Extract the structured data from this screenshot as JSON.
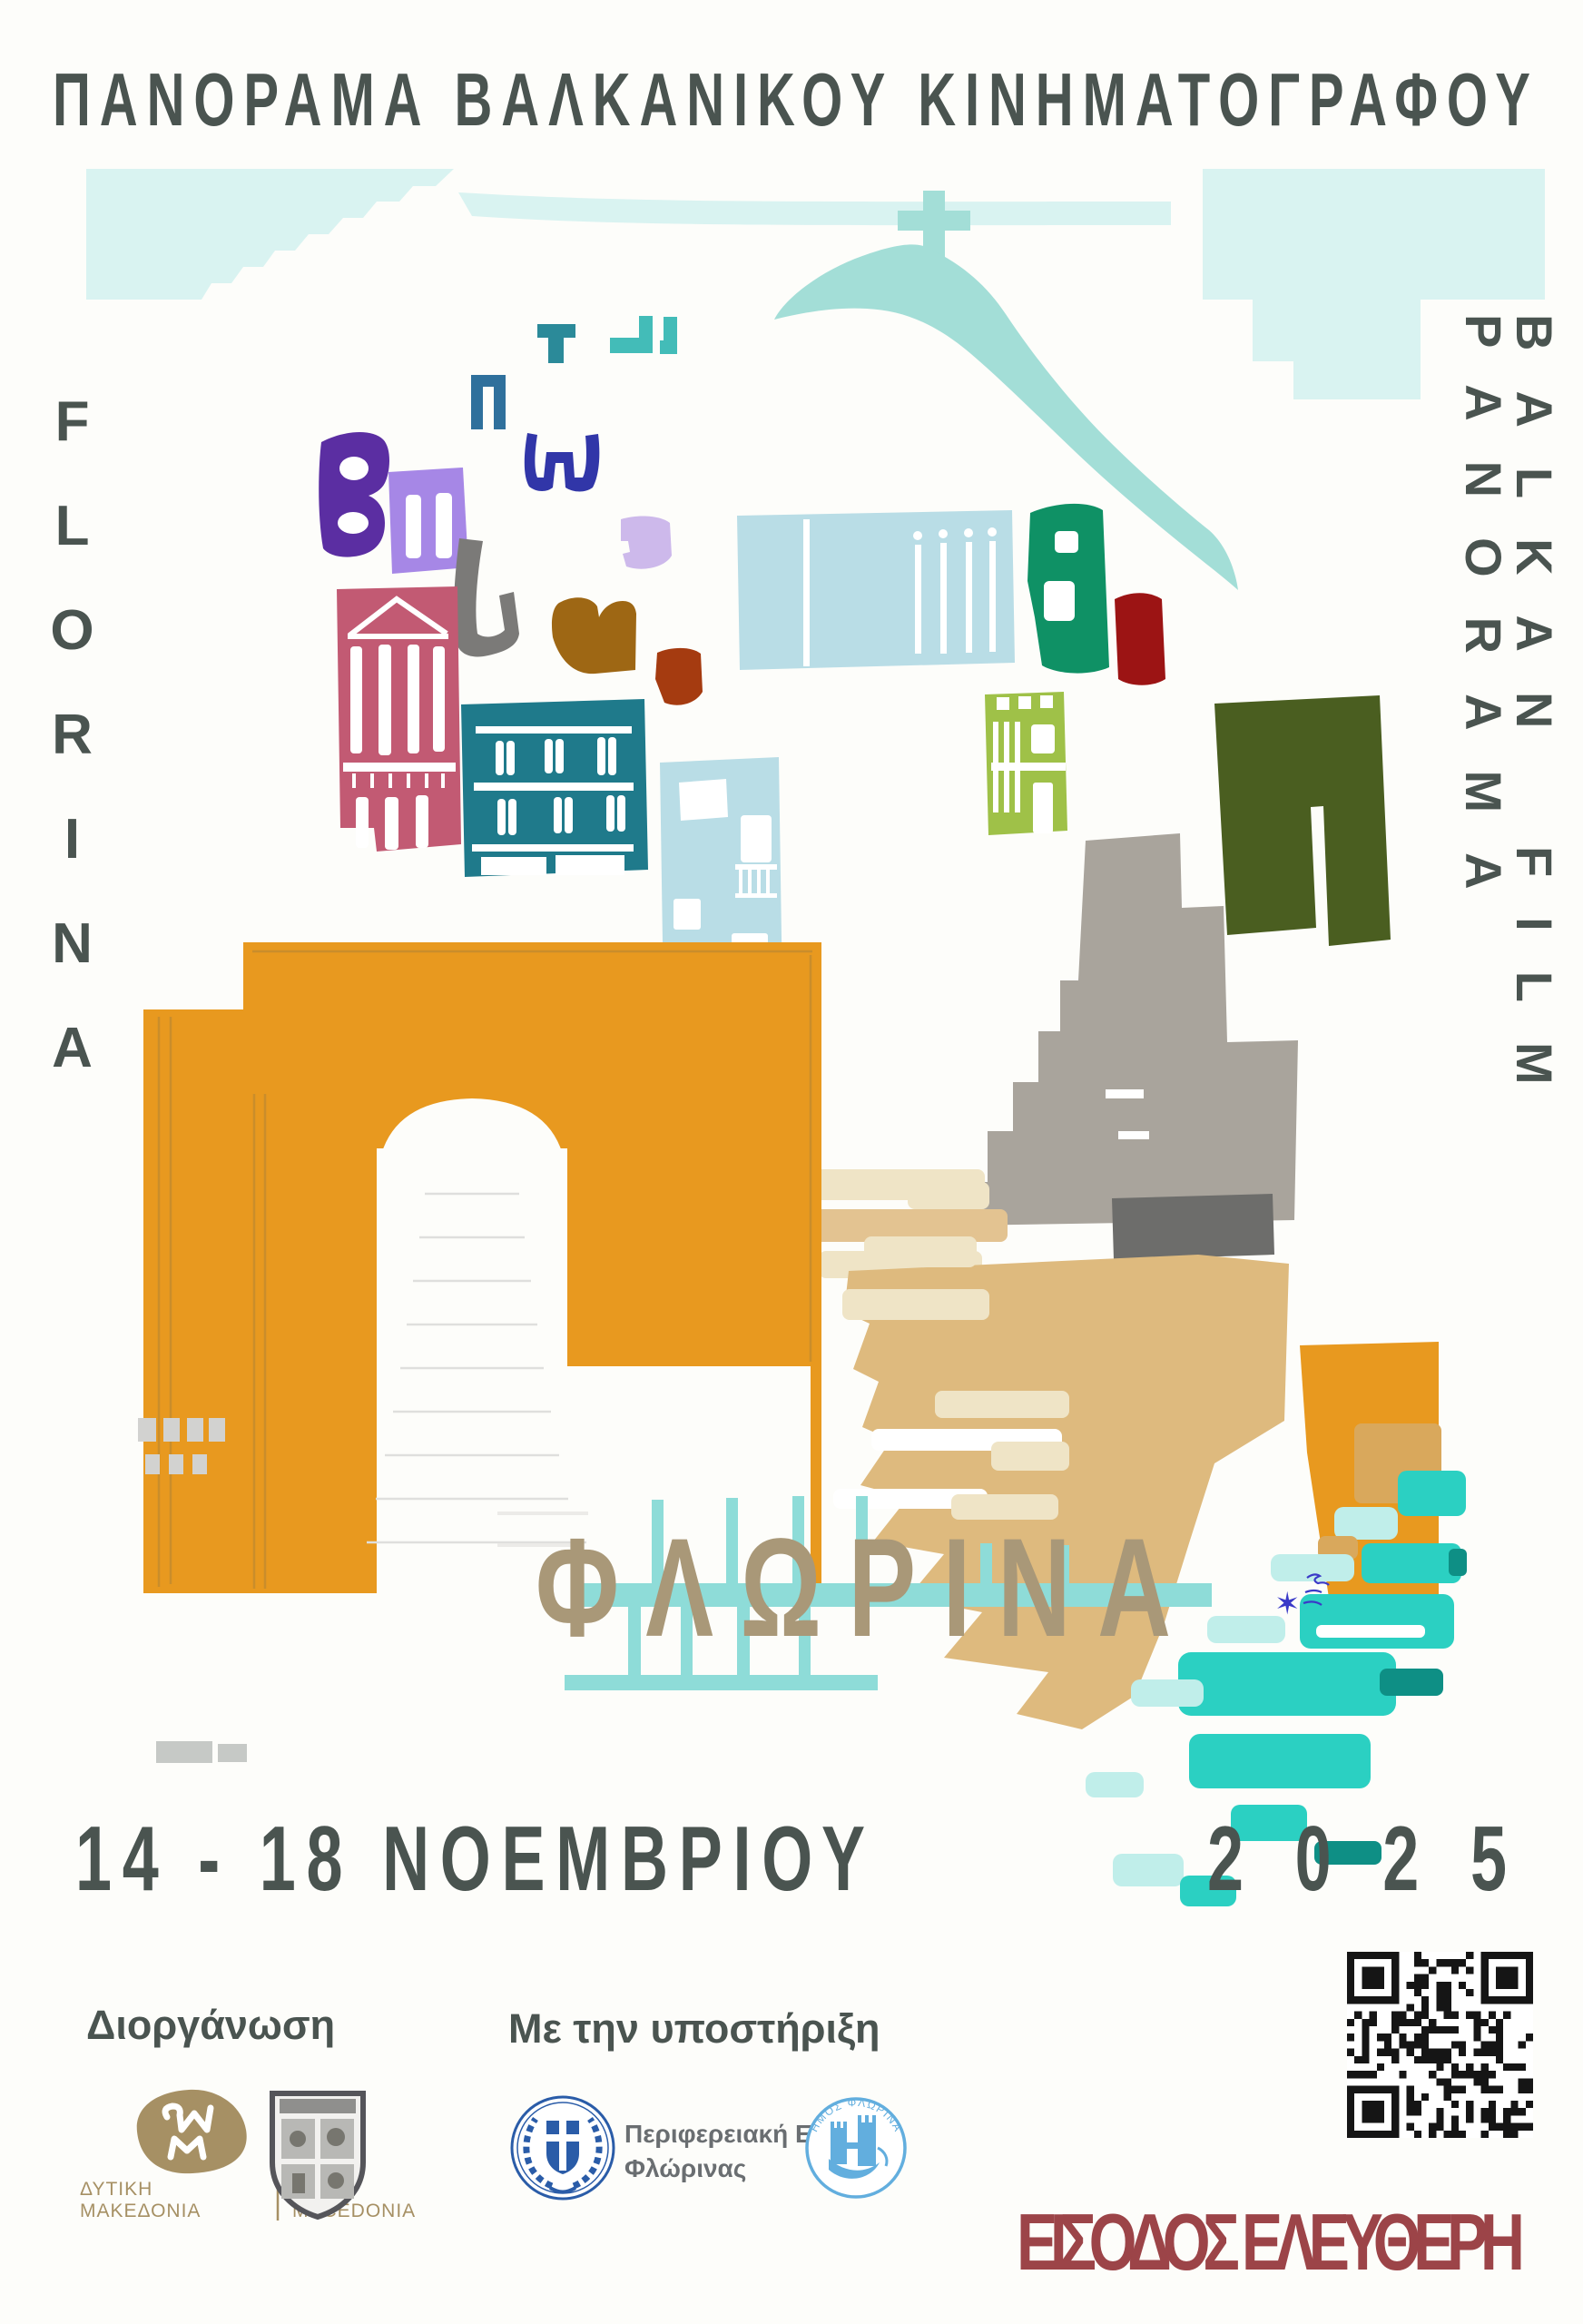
{
  "poster": {
    "title": "ΠΑΝΟΡΑΜΑ ΒΑΛΚΑΝΙΚΟΥ ΚΙΝΗΜΑΤΟΓΡΑΦΟΥ",
    "city_vertical_latin": "FLORINA",
    "festival_vertical_latin": "BALKAN FILM PANORAMA",
    "city_greek": "ΦΛΩΡΙΝΑ",
    "date_range": "14 - 18 ΝΟΕΜΒΡΙΟΥ",
    "year": "2025",
    "free_entry": "ΕΙΣΟΔΟΣ ΕΛΕΥΘΕΡΗ"
  },
  "footer": {
    "organizer_label": "Διοργάνωση",
    "support_label": "Με την υποστήριξη",
    "west_macedonia_logo": {
      "greek_line1": "ΔΥΤΙΚΗ",
      "greek_line2": "ΜΑΚΕΔΟΝΙΑ",
      "latin_line1": "WEST",
      "latin_line2": "MACEDONIA"
    },
    "regional_unit_logo": {
      "line1": "Περιφερειακή Ενότητα",
      "line2": "Φλώρινας"
    },
    "municipality_logo_arc": "ΔΗΜΟΣ ΦΛΩΡΙΝΑΣ"
  },
  "icons": {
    "signature_star": "✶"
  },
  "palette": {
    "ink": "#4a5450",
    "paper": "#fdfdfa",
    "sky": "#d9f3f1",
    "hill": "#a3ded7",
    "tan_text": "#a99878",
    "red_accent": "#9c4448",
    "arch_orange": "#e8991f",
    "pinstripe": "#c28a2e",
    "camel": "#deba7e",
    "camel_light": "#e3c391",
    "cream": "#efe4c6",
    "turquoise": "#2bd0c2",
    "pale_turquoise": "#c0eeea",
    "deep_turquoise": "#0e8f85",
    "rail": "#8edcd8",
    "purple": "#5b2ea2",
    "lilac": "#a687e6",
    "navy": "#3136a8",
    "lavender": "#cdb9eb",
    "steel_blue": "#2f709c",
    "teal_dark": "#1f7a8b",
    "teal": "#2b8a99",
    "cyan": "#43bcb8",
    "gray_u": "#7b7a78",
    "brown": "#9e6714",
    "rust": "#a53b10",
    "pink": "#c25a73",
    "light_blue": "#b9dde6",
    "emerald": "#0f9165",
    "dark_red": "#9c1414",
    "yellow_green": "#9fc148",
    "olive": "#4a5e20",
    "gray_block": "#a9a49c",
    "dark_gray": "#6d6d6b",
    "wm_tan": "#a69064",
    "gov_blue": "#2a5ca8",
    "muni_blue": "#62aede",
    "crest_gray": "#55555a",
    "label_gray": "#6a6e71",
    "qr_black": "#151515",
    "signature_blue": "#3a3ac8"
  }
}
